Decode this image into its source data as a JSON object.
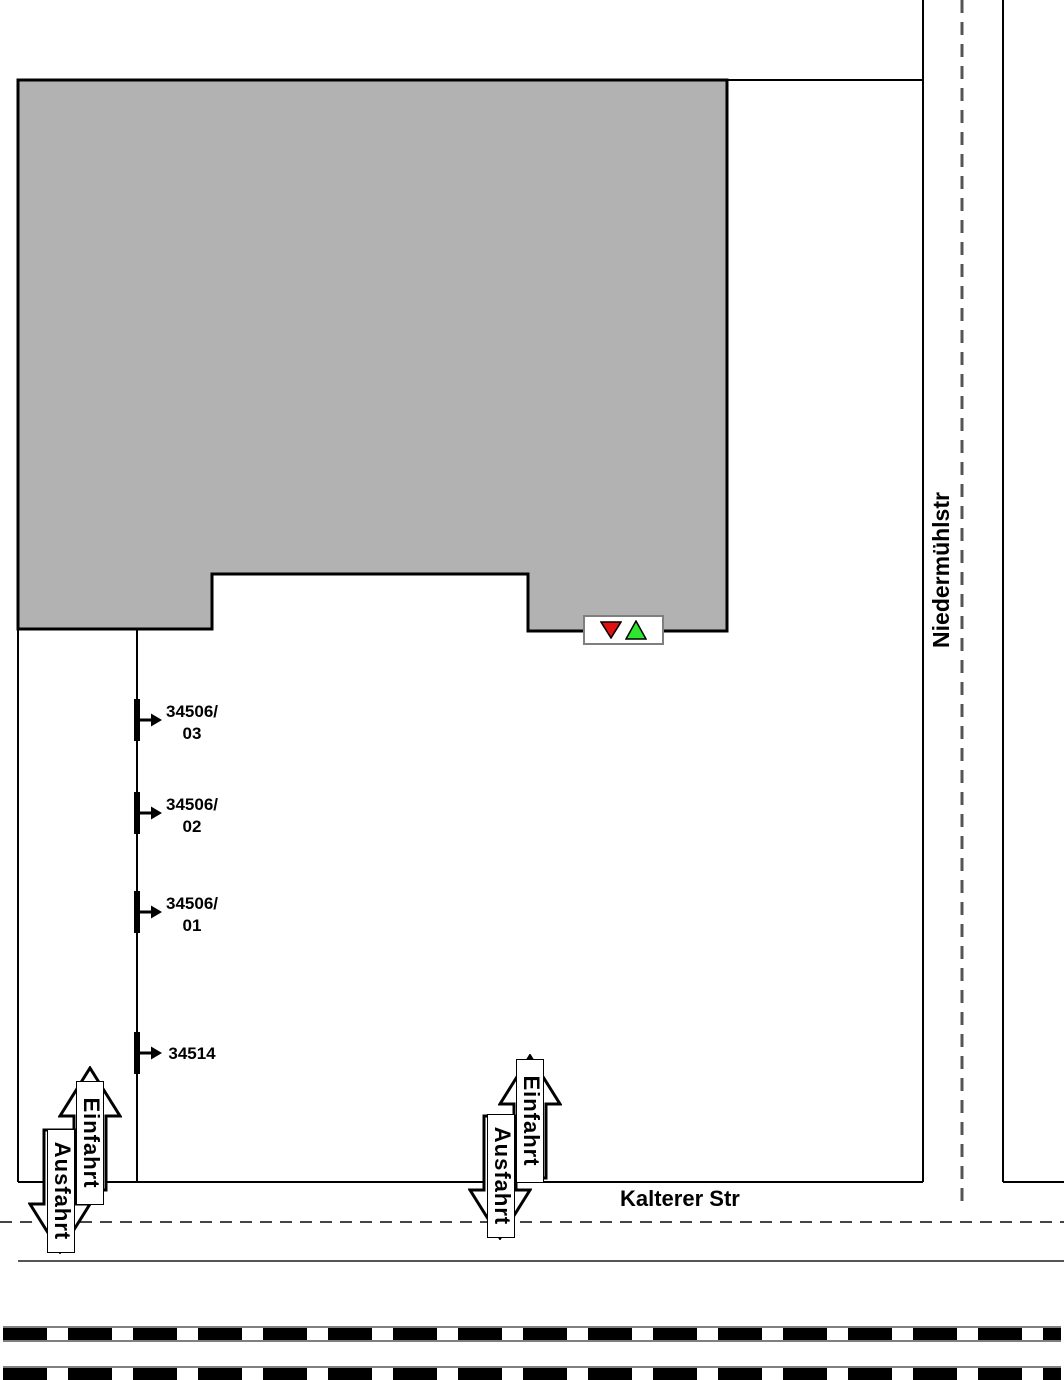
{
  "plan": {
    "streets": {
      "vertical": "Niedermühlstr",
      "horizontal": "Kalterer Str"
    },
    "driveways": {
      "in_label": "Einfahrt",
      "out_label": "Ausfahrt"
    },
    "gates": [
      {
        "id_line1": "34506/",
        "id_line2": "03"
      },
      {
        "id_line1": "34506/",
        "id_line2": "02"
      },
      {
        "id_line1": "34506/",
        "id_line2": "01"
      },
      {
        "id_line1": "34514",
        "id_line2": ""
      }
    ],
    "signal": {
      "red": "#e01212",
      "green": "#2de62d"
    },
    "building_fill": "#b2b2b2"
  }
}
